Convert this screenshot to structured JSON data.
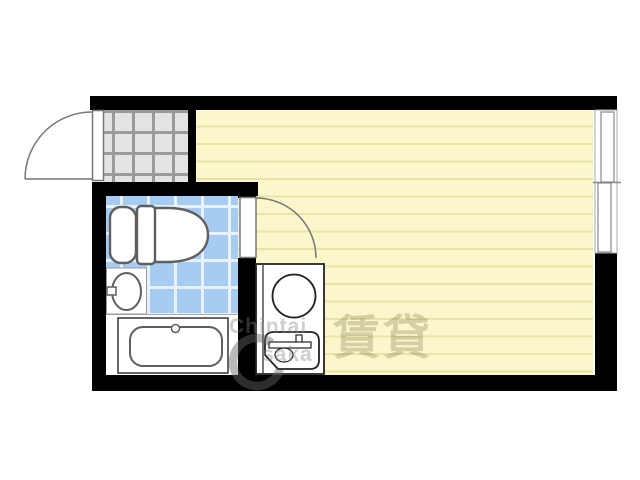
{
  "plan": {
    "type": "studio-apartment-floor-plan",
    "fixtures": [
      "entrance-door",
      "genkan-tile-floor",
      "toilet",
      "washbasin",
      "bathtub",
      "interior-door",
      "kitchen-unit",
      "stove-burner",
      "kitchen-sink",
      "sliding-window",
      "main-room-flooring",
      "bathroom-tile-floor"
    ]
  },
  "watermark": {
    "line1": "Chintai",
    "line2": "saka",
    "kanji": "賃貸",
    "logo": "ring-o-icon"
  },
  "colors": {
    "wall": "#000000",
    "room_floor": "#fbf7cb",
    "room_stripe": "#e9e2a9",
    "bath_tile": "#a6cdf1",
    "bath_grid": "#e9f2fc",
    "genkan_tile": "#e3e3e3",
    "genkan_grid": "#9a9a9a",
    "fixture_stroke": "#5f5f5f"
  }
}
